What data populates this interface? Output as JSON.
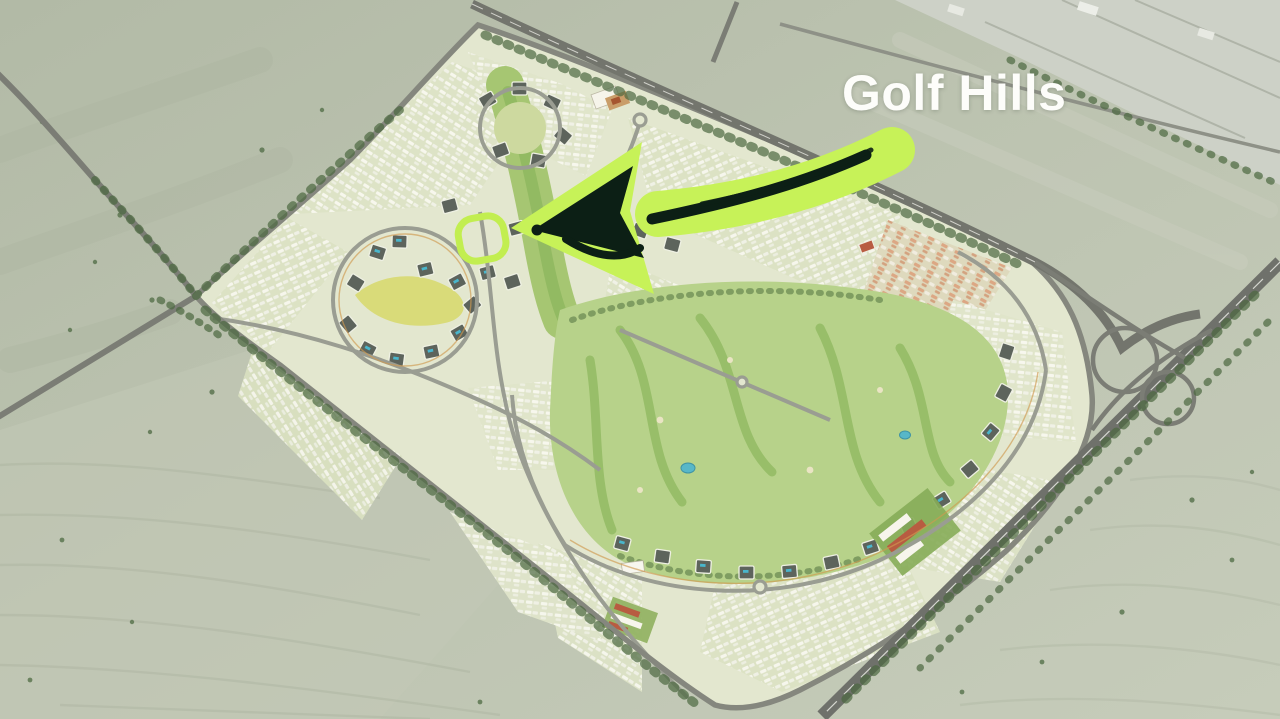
{
  "annotation": {
    "label": "Golf Hills",
    "label_color": "#fdfdfa",
    "highlight_color": "#c7f258",
    "ink_color": "#0c1f15",
    "ring_color": "#c2ee50"
  },
  "map": {
    "type": "aerial master plan render",
    "terrain": "desert",
    "features": [
      "master-planned community with central golf course",
      "dense residential housing clusters",
      "apartment blocks ringed around parks",
      "winding golf fairways and ponds",
      "perimeter ring road lined with trees",
      "highway along the north-east edge",
      "highway interchange with loop ramps on the east side",
      "highway crossing the bottom-right corner",
      "desert crossroads west of the community",
      "light paved area in the top-right corner"
    ]
  }
}
